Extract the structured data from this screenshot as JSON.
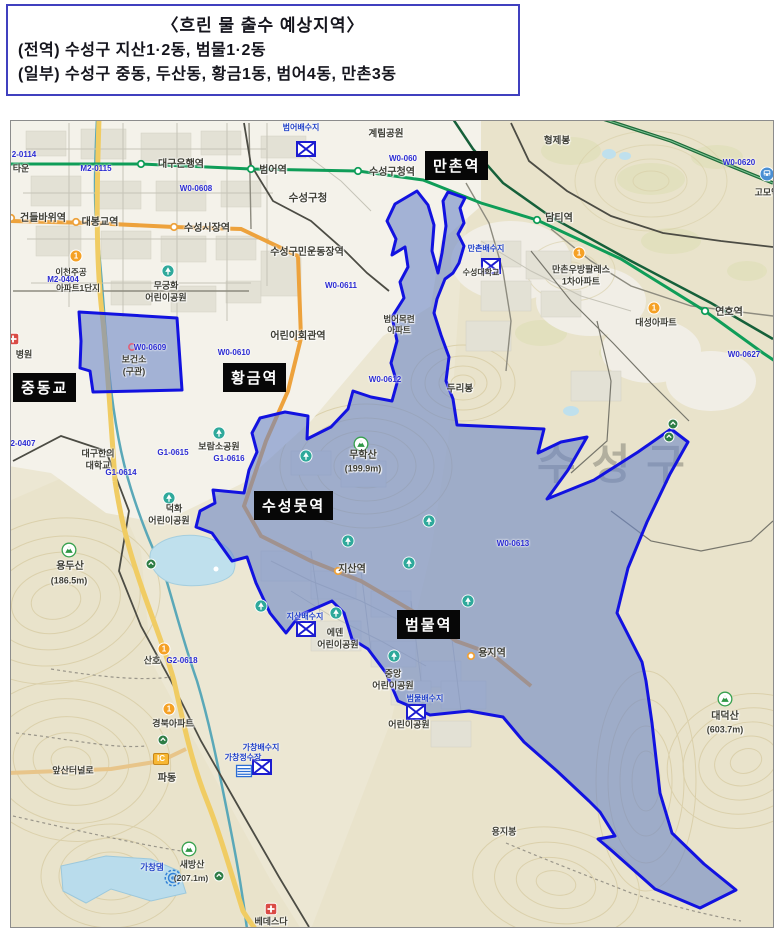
{
  "header": {
    "title": "〈흐린 물 출수 예상지역〉",
    "lines": [
      "(전역) 수성구 지산1·2동, 범물1·2동",
      "(일부) 수성구 중동, 두산동, 황금1동, 범어4동, 만촌3동"
    ]
  },
  "map": {
    "watermark": "수성구",
    "colors": {
      "zone_fill": "#6d87c6",
      "zone_border": "#1212e0",
      "label_box_bg": "#070707",
      "subway_line2": "#0f9d58",
      "subway_line3": "#eda23c",
      "water": "#bfe0ed",
      "code_text": "#2a2ad2"
    },
    "station_boxes": [
      {
        "label": "만촌역",
        "x": 414,
        "y": 30
      },
      {
        "label": "중동교",
        "x": 2,
        "y": 252
      },
      {
        "label": "황금역",
        "x": 212,
        "y": 242
      },
      {
        "label": "수성못역",
        "x": 243,
        "y": 370
      },
      {
        "label": "범물역",
        "x": 386,
        "y": 489
      }
    ],
    "labels": [
      {
        "t": "대구은행역",
        "x": 170,
        "y": 44,
        "c": "place",
        "s": 10
      },
      {
        "t": "범어역",
        "x": 262,
        "y": 50,
        "c": "place",
        "s": 10
      },
      {
        "t": "건들바위역",
        "x": 32,
        "y": 98,
        "c": "place",
        "s": 10
      },
      {
        "t": "대봉교역",
        "x": 89,
        "y": 102,
        "c": "place",
        "s": 10
      },
      {
        "t": "수성시장역",
        "x": 196,
        "y": 108,
        "c": "place",
        "s": 10
      },
      {
        "t": "수성구청",
        "x": 297,
        "y": 77,
        "c": "place",
        "s": 10.5
      },
      {
        "t": "수성구청역",
        "x": 381,
        "y": 52,
        "c": "place",
        "s": 10
      },
      {
        "t": "수성구민운동장역",
        "x": 296,
        "y": 132,
        "c": "place",
        "s": 10
      },
      {
        "t": "계림공원",
        "x": 375,
        "y": 13,
        "c": "place",
        "s": 9.5
      },
      {
        "t": "형제봉",
        "x": 546,
        "y": 20,
        "c": "place",
        "s": 9.5
      },
      {
        "t": "담티역",
        "x": 548,
        "y": 98,
        "c": "place",
        "s": 10
      },
      {
        "t": "만촌우방팔레스",
        "x": 570,
        "y": 149,
        "c": "place",
        "s": 9
      },
      {
        "t": "1차아파트",
        "x": 570,
        "y": 161,
        "c": "place",
        "s": 9
      },
      {
        "t": "고모역",
        "x": 756,
        "y": 72,
        "c": "place",
        "s": 9
      },
      {
        "t": "연호역",
        "x": 718,
        "y": 192,
        "c": "place",
        "s": 10
      },
      {
        "t": "대성아파트",
        "x": 645,
        "y": 202,
        "c": "place",
        "s": 9
      },
      {
        "t": "어린이회관역",
        "x": 287,
        "y": 216,
        "c": "place",
        "s": 10
      },
      {
        "t": "범어목련",
        "x": 388,
        "y": 198,
        "c": "place",
        "s": 8.5
      },
      {
        "t": "아파트",
        "x": 388,
        "y": 209,
        "c": "place",
        "s": 8.5
      },
      {
        "t": "수성대학교",
        "x": 470,
        "y": 152,
        "c": "place",
        "s": 8
      },
      {
        "t": "두리봉",
        "x": 449,
        "y": 268,
        "c": "place",
        "s": 9.5
      },
      {
        "t": "무학산",
        "x": 352,
        "y": 335,
        "c": "place",
        "s": 10
      },
      {
        "t": "(199.9m)",
        "x": 352,
        "y": 348,
        "c": "place",
        "s": 9
      },
      {
        "t": "지산역",
        "x": 341,
        "y": 449,
        "c": "place",
        "s": 10
      },
      {
        "t": "에덴",
        "x": 324,
        "y": 512,
        "c": "place",
        "s": 9
      },
      {
        "t": "어린이공원",
        "x": 327,
        "y": 524,
        "c": "place",
        "s": 9
      },
      {
        "t": "용지역",
        "x": 481,
        "y": 533,
        "c": "place",
        "s": 10
      },
      {
        "t": "중앙",
        "x": 382,
        "y": 553,
        "c": "place",
        "s": 9
      },
      {
        "t": "어린이공원",
        "x": 382,
        "y": 565,
        "c": "place",
        "s": 9
      },
      {
        "t": "어린이공원",
        "x": 398,
        "y": 604,
        "c": "place",
        "s": 9
      },
      {
        "t": "무궁화",
        "x": 155,
        "y": 165,
        "c": "place",
        "s": 9
      },
      {
        "t": "어린이공원",
        "x": 155,
        "y": 177,
        "c": "place",
        "s": 9
      },
      {
        "t": "보건소",
        "x": 123,
        "y": 239,
        "c": "place",
        "s": 9
      },
      {
        "t": "(구관)",
        "x": 123,
        "y": 251,
        "c": "place",
        "s": 9
      },
      {
        "t": "보람소공원",
        "x": 208,
        "y": 326,
        "c": "place",
        "s": 9
      },
      {
        "t": "대구한의",
        "x": 87,
        "y": 333,
        "c": "place",
        "s": 9
      },
      {
        "t": "대학교",
        "x": 87,
        "y": 345,
        "c": "place",
        "s": 9
      },
      {
        "t": "덕화",
        "x": 163,
        "y": 388,
        "c": "place",
        "s": 9
      },
      {
        "t": "어린이공원",
        "x": 158,
        "y": 400,
        "c": "place",
        "s": 9
      },
      {
        "t": "용두산",
        "x": 59,
        "y": 446,
        "c": "place",
        "s": 10
      },
      {
        "t": "(186.5m)",
        "x": 58,
        "y": 460,
        "c": "place",
        "s": 9
      },
      {
        "t": "산호",
        "x": 141,
        "y": 540,
        "c": "place",
        "s": 9
      },
      {
        "t": "경북아파트",
        "x": 162,
        "y": 603,
        "c": "place",
        "s": 9
      },
      {
        "t": "앞산터널로",
        "x": 62,
        "y": 650,
        "c": "place",
        "s": 9
      },
      {
        "t": "파동",
        "x": 156,
        "y": 658,
        "c": "place",
        "s": 10
      },
      {
        "t": "대덕산",
        "x": 714,
        "y": 596,
        "c": "place",
        "s": 10
      },
      {
        "t": "(603.7m)",
        "x": 714,
        "y": 609,
        "c": "place",
        "s": 9
      },
      {
        "t": "용지봉",
        "x": 493,
        "y": 711,
        "c": "place",
        "s": 9
      },
      {
        "t": "새방산",
        "x": 181,
        "y": 744,
        "c": "place",
        "s": 9
      },
      {
        "t": "(207.1m)",
        "x": 180,
        "y": 757,
        "c": "place",
        "s": 8.5
      },
      {
        "t": "베데스다",
        "x": 260,
        "y": 801,
        "c": "place",
        "s": 9
      },
      {
        "t": "병원",
        "x": 13,
        "y": 234,
        "c": "place",
        "s": 9
      },
      {
        "t": "이천주공",
        "x": 60,
        "y": 151,
        "c": "place",
        "s": 8.5
      },
      {
        "t": "아파트1단지",
        "x": 67,
        "y": 167,
        "c": "place",
        "s": 8.5
      },
      {
        "t": "타운",
        "x": 10,
        "y": 48,
        "c": "place",
        "s": 9
      },
      {
        "t": "2-0114",
        "x": 13,
        "y": 34,
        "c": "code",
        "s": 8
      },
      {
        "t": "M2-0115",
        "x": 85,
        "y": 48,
        "c": "code",
        "s": 8
      },
      {
        "t": "W0-0608",
        "x": 185,
        "y": 68,
        "c": "code",
        "s": 8
      },
      {
        "t": "W0-060",
        "x": 392,
        "y": 38,
        "c": "code",
        "s": 8
      },
      {
        "t": "M2-0404",
        "x": 52,
        "y": 159,
        "c": "code",
        "s": 8
      },
      {
        "t": "W0-0609",
        "x": 139,
        "y": 227,
        "c": "code",
        "s": 8
      },
      {
        "t": "W0-0610",
        "x": 223,
        "y": 232,
        "c": "code",
        "s": 8
      },
      {
        "t": "W0-0611",
        "x": 330,
        "y": 165,
        "c": "code",
        "s": 8
      },
      {
        "t": "W0-0612",
        "x": 374,
        "y": 259,
        "c": "code",
        "s": 8
      },
      {
        "t": "W0-0613",
        "x": 502,
        "y": 423,
        "c": "code",
        "s": 8
      },
      {
        "t": "W0-0620",
        "x": 728,
        "y": 42,
        "c": "code",
        "s": 8
      },
      {
        "t": "W0-0627",
        "x": 733,
        "y": 234,
        "c": "code",
        "s": 8
      },
      {
        "t": "2-0407",
        "x": 12,
        "y": 323,
        "c": "code",
        "s": 8
      },
      {
        "t": "G1-0615",
        "x": 162,
        "y": 332,
        "c": "code",
        "s": 8
      },
      {
        "t": "G1-0614",
        "x": 110,
        "y": 352,
        "c": "code",
        "s": 8
      },
      {
        "t": "G1-0616",
        "x": 218,
        "y": 338,
        "c": "code",
        "s": 8
      },
      {
        "t": "G2-0618",
        "x": 171,
        "y": 540,
        "c": "code",
        "s": 8
      },
      {
        "t": "범어배수지",
        "x": 290,
        "y": 7,
        "c": "resv",
        "s": 8
      },
      {
        "t": "만촌배수지",
        "x": 475,
        "y": 128,
        "c": "resv",
        "s": 8
      },
      {
        "t": "지산배수지",
        "x": 294,
        "y": 496,
        "c": "resv",
        "s": 8
      },
      {
        "t": "범물배수지",
        "x": 414,
        "y": 578,
        "c": "resv",
        "s": 8
      },
      {
        "t": "가창배수지",
        "x": 250,
        "y": 627,
        "c": "resv",
        "s": 8
      },
      {
        "t": "가창정수장",
        "x": 232,
        "y": 637,
        "c": "resv",
        "s": 8
      },
      {
        "t": "가창댐",
        "x": 141,
        "y": 746,
        "c": "resv",
        "s": 8.5
      },
      {
        "t": "1",
        "x": 65,
        "y": 135,
        "c": "badge1",
        "s": 8
      },
      {
        "t": "1",
        "x": 568,
        "y": 132,
        "c": "badge1",
        "s": 8
      },
      {
        "t": "1",
        "x": 643,
        "y": 187,
        "c": "badge1",
        "s": 8
      },
      {
        "t": "1",
        "x": 158,
        "y": 588,
        "c": "badge1",
        "s": 8
      },
      {
        "t": "1",
        "x": 153,
        "y": 528,
        "c": "badge1",
        "s": 8
      },
      {
        "t": "IC",
        "x": 150,
        "y": 638,
        "c": "ic",
        "s": 8
      }
    ],
    "icons": [
      {
        "t": "resx",
        "x": 295,
        "y": 28
      },
      {
        "t": "resx",
        "x": 480,
        "y": 145
      },
      {
        "t": "resx",
        "x": 295,
        "y": 508
      },
      {
        "t": "resx",
        "x": 405,
        "y": 591
      },
      {
        "t": "resx",
        "x": 251,
        "y": 646
      },
      {
        "t": "park",
        "x": 157,
        "y": 150
      },
      {
        "t": "park",
        "x": 208,
        "y": 312
      },
      {
        "t": "park",
        "x": 158,
        "y": 377
      },
      {
        "t": "park",
        "x": 325,
        "y": 492
      },
      {
        "t": "park",
        "x": 383,
        "y": 535
      },
      {
        "t": "park",
        "x": 295,
        "y": 335
      },
      {
        "t": "park",
        "x": 337,
        "y": 420
      },
      {
        "t": "park",
        "x": 398,
        "y": 442
      },
      {
        "t": "park",
        "x": 418,
        "y": 400
      },
      {
        "t": "park",
        "x": 457,
        "y": 480
      },
      {
        "t": "park",
        "x": 250,
        "y": 485
      },
      {
        "t": "mtn",
        "x": 350,
        "y": 323
      },
      {
        "t": "mtn",
        "x": 58,
        "y": 429
      },
      {
        "t": "mtn",
        "x": 714,
        "y": 578
      },
      {
        "t": "mtn",
        "x": 178,
        "y": 728
      },
      {
        "t": "grn",
        "x": 662,
        "y": 303
      },
      {
        "t": "grn",
        "x": 658,
        "y": 316
      },
      {
        "t": "grn",
        "x": 140,
        "y": 443
      },
      {
        "t": "grn",
        "x": 152,
        "y": 619
      },
      {
        "t": "grn",
        "x": 208,
        "y": 755
      },
      {
        "t": "st2",
        "x": 130,
        "y": 43
      },
      {
        "t": "st2",
        "x": 240,
        "y": 48
      },
      {
        "t": "st2",
        "x": 347,
        "y": 50
      },
      {
        "t": "st2",
        "x": 526,
        "y": 99
      },
      {
        "t": "st2",
        "x": 694,
        "y": 190
      },
      {
        "t": "st3",
        "x": 0,
        "y": 97
      },
      {
        "t": "st3",
        "x": 65,
        "y": 101
      },
      {
        "t": "st3",
        "x": 163,
        "y": 106
      },
      {
        "t": "st3",
        "x": 287,
        "y": 217
      },
      {
        "t": "st3",
        "x": 327,
        "y": 450
      },
      {
        "t": "st3",
        "x": 460,
        "y": 535
      },
      {
        "t": "hosp",
        "x": 2,
        "y": 218
      },
      {
        "t": "hosp",
        "x": 260,
        "y": 788
      },
      {
        "t": "train",
        "x": 756,
        "y": 53
      },
      {
        "t": "dam",
        "x": 162,
        "y": 757
      },
      {
        "t": "plant",
        "x": 233,
        "y": 650
      },
      {
        "t": "ring",
        "x": 121,
        "y": 226
      }
    ]
  }
}
